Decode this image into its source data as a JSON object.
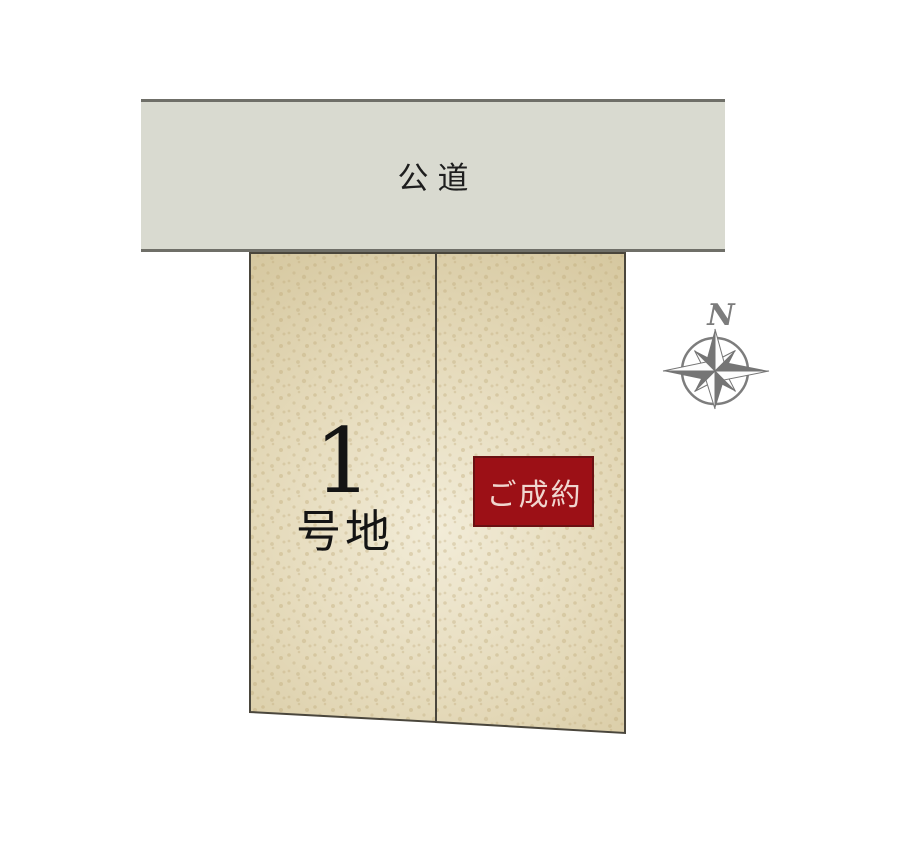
{
  "road": {
    "label": "公道"
  },
  "lots": [
    {
      "name": "lot-1",
      "label_number": "1",
      "label_suffix": "号地"
    },
    {
      "name": "lot-2",
      "badge_label": "ご成約"
    }
  ],
  "compass": {
    "label": "N"
  },
  "colors": {
    "road_fill": "#d9dad0",
    "road_border": "#6f6f68",
    "land_fill_center": "#f2ecd8",
    "land_fill_edge": "#d6c8a0",
    "land_border": "#4a463c",
    "badge_background": "#9c1016",
    "badge_border": "#6a1012",
    "badge_text": "#f0d6cf",
    "compass_gray": "#7d7d7d",
    "label_text": "#141414",
    "road_text": "#1e1e1e"
  }
}
